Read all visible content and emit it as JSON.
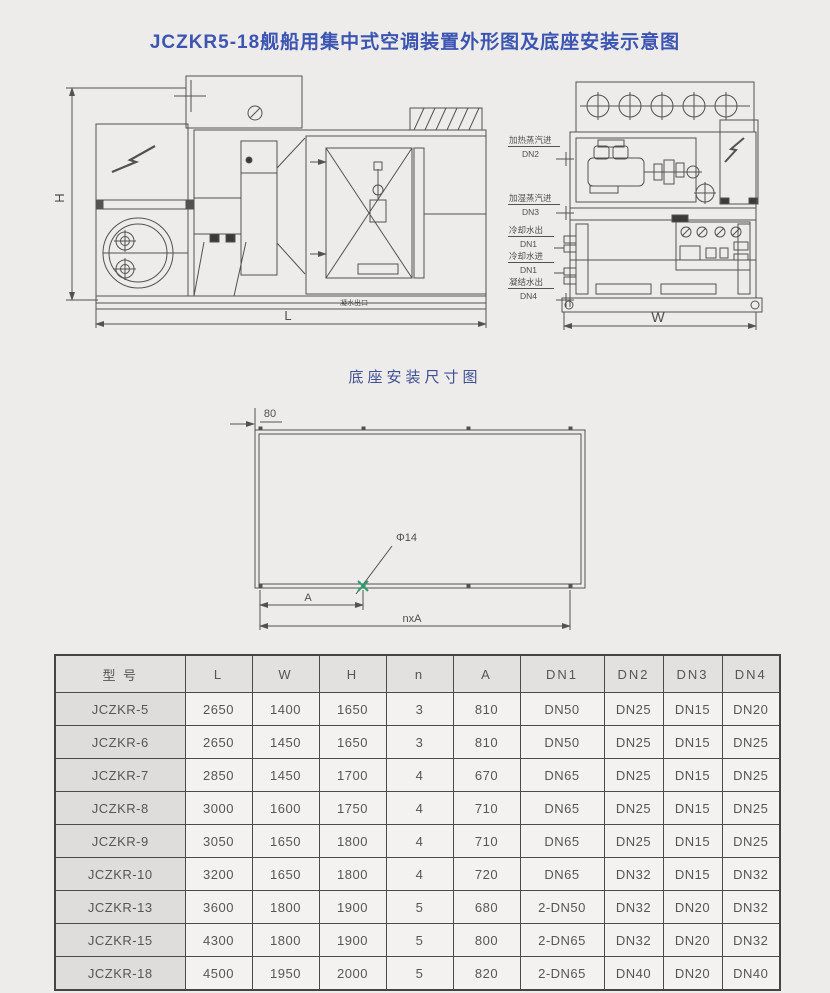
{
  "page": {
    "title": "JCZKR5-18舰船用集中式空调装置外形图及底座安装示意图",
    "base_section_title": "底座安装尺寸图"
  },
  "outline": {
    "dims": {
      "H": "H",
      "L": "L",
      "W": "W"
    },
    "condensate_note": "凝水出口",
    "ports": [
      {
        "label": "加热蒸汽进",
        "dn": "DN2"
      },
      {
        "label": "加湿蒸汽进",
        "dn": "DN3"
      },
      {
        "label": "冷却水出",
        "dn": "DN1"
      },
      {
        "label": "冷却水进",
        "dn": "DN1"
      },
      {
        "label": "凝结水出",
        "dn": "DN4"
      }
    ]
  },
  "base_diagram": {
    "edge_dim": "80",
    "hole_label": "Φ14",
    "pitch_label": "A",
    "total_label": "nxA"
  },
  "table": {
    "headers": [
      "型  号",
      "L",
      "W",
      "H",
      "n",
      "A",
      "DN1",
      "DN2",
      "DN3",
      "DN4"
    ],
    "rows": [
      [
        "JCZKR-5",
        "2650",
        "1400",
        "1650",
        "3",
        "810",
        "DN50",
        "DN25",
        "DN15",
        "DN20"
      ],
      [
        "JCZKR-6",
        "2650",
        "1450",
        "1650",
        "3",
        "810",
        "DN50",
        "DN25",
        "DN15",
        "DN25"
      ],
      [
        "JCZKR-7",
        "2850",
        "1450",
        "1700",
        "4",
        "670",
        "DN65",
        "DN25",
        "DN15",
        "DN25"
      ],
      [
        "JCZKR-8",
        "3000",
        "1600",
        "1750",
        "4",
        "710",
        "DN65",
        "DN25",
        "DN15",
        "DN25"
      ],
      [
        "JCZKR-9",
        "3050",
        "1650",
        "1800",
        "4",
        "710",
        "DN65",
        "DN25",
        "DN15",
        "DN25"
      ],
      [
        "JCZKR-10",
        "3200",
        "1650",
        "1800",
        "4",
        "720",
        "DN65",
        "DN32",
        "DN15",
        "DN32"
      ],
      [
        "JCZKR-13",
        "3600",
        "1800",
        "1900",
        "5",
        "680",
        "2-DN50",
        "DN32",
        "DN20",
        "DN32"
      ],
      [
        "JCZKR-15",
        "4300",
        "1800",
        "1900",
        "5",
        "800",
        "2-DN65",
        "DN32",
        "DN20",
        "DN32"
      ],
      [
        "JCZKR-18",
        "4500",
        "1950",
        "2000",
        "5",
        "820",
        "2-DN65",
        "DN40",
        "DN20",
        "DN40"
      ]
    ]
  },
  "colors": {
    "title_blue": "#3c55b2",
    "section_blue": "#3f5094",
    "line_gray": "#525252",
    "hole_mark_green": "#2f9e6e"
  }
}
